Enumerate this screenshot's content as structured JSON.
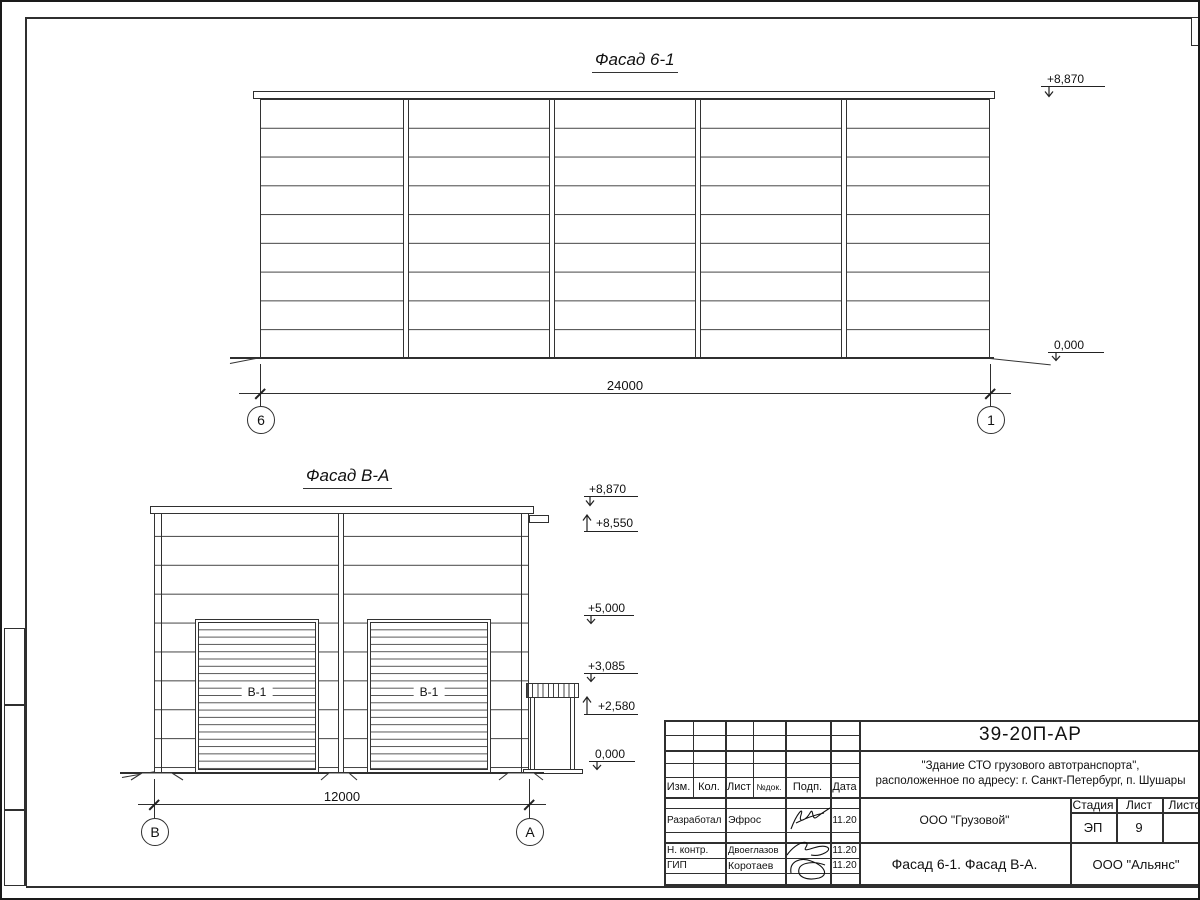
{
  "drawing": {
    "facade1": {
      "title": "Фасад 6-1",
      "dim": "24000",
      "axis_left": "6",
      "axis_right": "1",
      "lev_top": "+8,870",
      "lev_zero": "0,000"
    },
    "facade2": {
      "title": "Фасад В-А",
      "dim": "12000",
      "axis_left": "В",
      "axis_right": "А",
      "door_label": "В-1",
      "lev_top": "+8,870",
      "lev_roof": "+8,550",
      "lev_mid": "+5,000",
      "lev_canopy_top": "+3,085",
      "lev_canopy_bottom": "+2,580",
      "lev_zero": "0,000"
    }
  },
  "titleblock": {
    "code": "39-20П-АР",
    "project_line1": "\"Здание СТО грузового автотранспорта\",",
    "project_line2": "расположенное по адресу: г. Санкт-Петербург, п. Шушары",
    "client": "ООО \"Грузовой\"",
    "sheet_title": "Фасад 6-1. Фасад В-А.",
    "organization": "ООО \"Альянс\"",
    "stage_label": "Стадия",
    "stage_value": "ЭП",
    "sheet_label": "Лист",
    "sheet_value": "9",
    "sheets_label": "Листов",
    "rev_headers": [
      "Изм.",
      "Кол.",
      "Лист",
      "№док.",
      "Подп.",
      "Дата"
    ],
    "signoff": [
      {
        "role": "Разработал",
        "name": "Эфрос",
        "date": "11.20"
      },
      {
        "role": "Н. контр.",
        "name": "Двоеглазов",
        "date": "11.20"
      },
      {
        "role": "ГИП",
        "name": "Коротаев",
        "date": "11.20"
      }
    ]
  }
}
